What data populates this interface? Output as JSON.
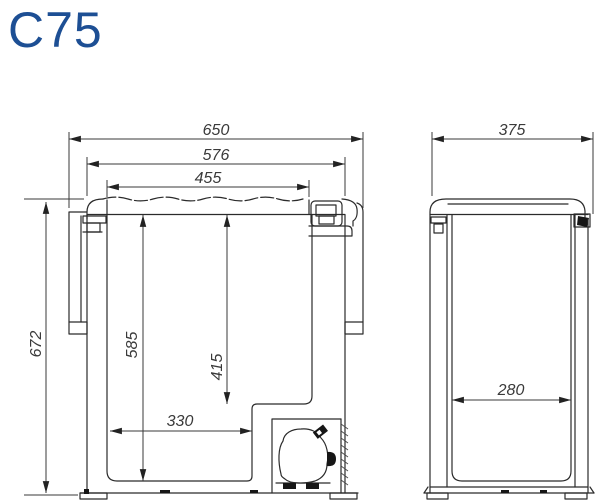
{
  "title": "C75",
  "colors": {
    "title": "#1d4f94",
    "line": "#2b2b2b",
    "dim_text": "#3a3a3a"
  },
  "views": {
    "front": {
      "dims": {
        "overall_width": "650",
        "housing_width": "576",
        "lid_top_width": "455",
        "overall_height": "672",
        "interior_depth": "585",
        "interior_depth_over_step": "415",
        "interior_floor_width": "330"
      }
    },
    "side": {
      "dims": {
        "overall_depth": "375",
        "interior_width": "280"
      }
    }
  }
}
